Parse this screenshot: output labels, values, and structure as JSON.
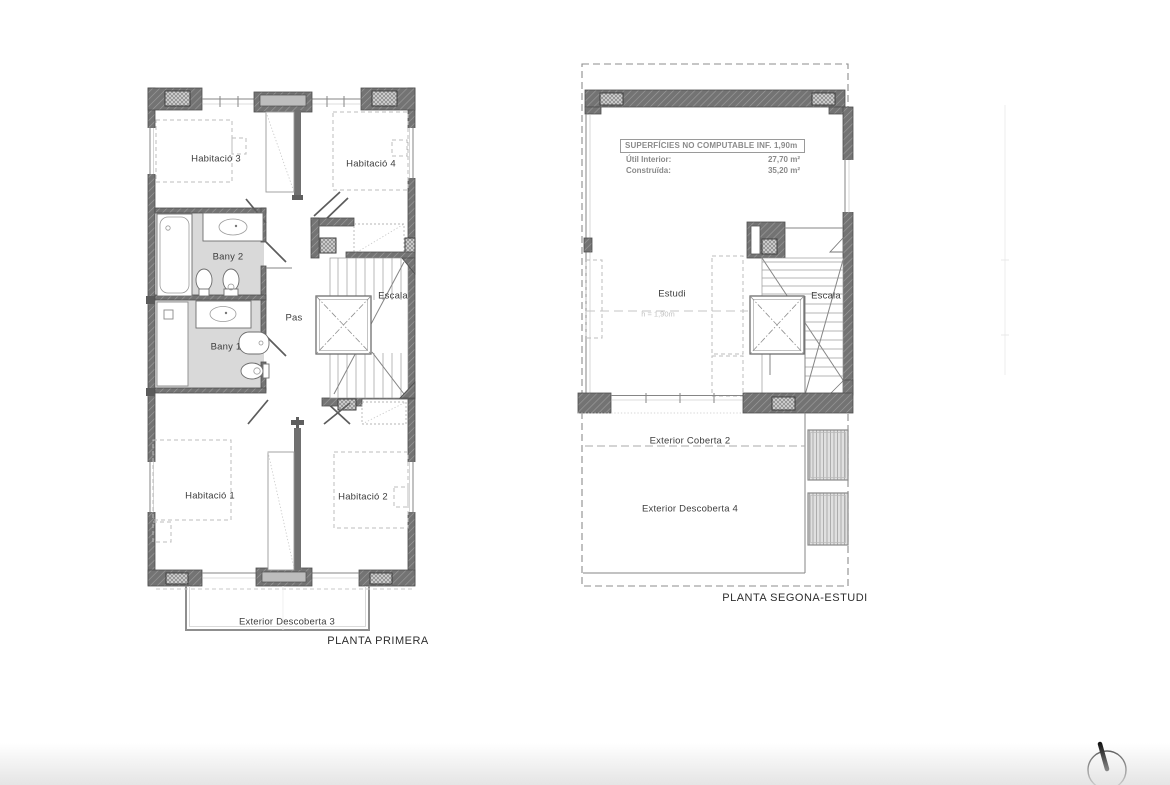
{
  "document": {
    "background": "#ffffff",
    "type": "architectural floor plans"
  },
  "plan_primera": {
    "title": "PLANTA PRIMERA",
    "labels": {
      "habitacio_3": "Habitació 3",
      "habitacio_4": "Habitació 4",
      "bany_2": "Bany 2",
      "bany_1": "Bany 1",
      "pas": "Pas",
      "escala": "Escala",
      "habitacio_1": "Habitació 1",
      "habitacio_2": "Habitació 2",
      "exterior_descoberta_3": "Exterior Descoberta 3"
    }
  },
  "plan_segona": {
    "title": "PLANTA SEGONA-ESTUDI",
    "labels": {
      "estudi": "Estudi",
      "escala": "Escala",
      "exterior_coberta_2": "Exterior Coberta 2",
      "exterior_descoberta_4": "Exterior Descoberta 4",
      "height_note": "h = 1,90m"
    },
    "surfaces_table": {
      "header": "SUPERFÍCIES NO COMPUTABLE INF. 1,90m",
      "rows": [
        {
          "label": "Útil Interior:",
          "value": "27,70 m²"
        },
        {
          "label": "Construïda:",
          "value": "35,20 m²"
        }
      ]
    }
  },
  "icons": {
    "north_arrow": "north-arrow-compass"
  },
  "colors": {
    "wall": "#737373",
    "wall_hatch": "#9c9c9c",
    "pillar_fill": "#d0d0d0",
    "bath_floor": "#d9d9d9",
    "dashed_furniture": "#bdbdbd",
    "label_text": "#3d3d3d",
    "table_text": "#8a8a8a"
  }
}
